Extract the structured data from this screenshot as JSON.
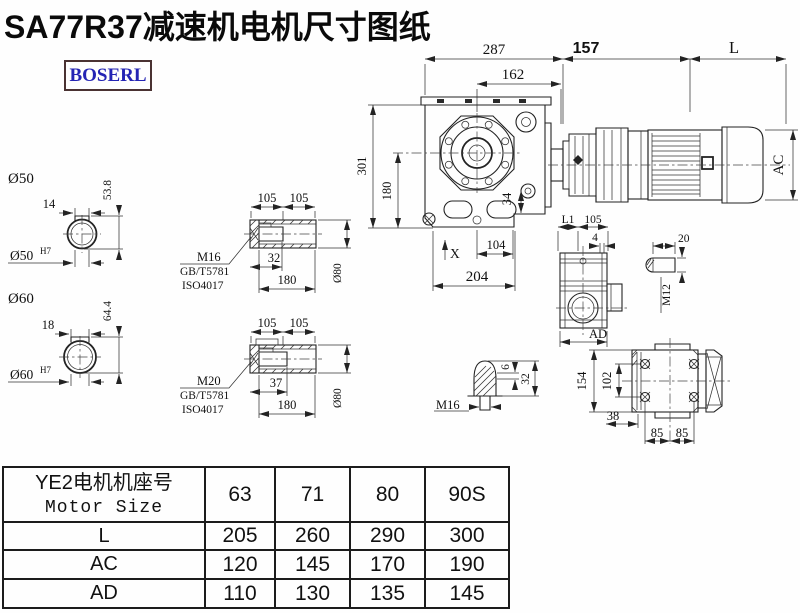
{
  "title": "SA77R37减速机电机尺寸图纸",
  "logo": "BOSERL",
  "main_view": {
    "d287": "287",
    "d162": "162",
    "d157": "157",
    "dL": "L",
    "dAC": "AC",
    "d301": "301",
    "d180": "180",
    "d34": "34",
    "dX": "X",
    "d104": "104",
    "d204": "204"
  },
  "shaft50": {
    "dia": "Ø50",
    "key_w": "14",
    "height": "53.8",
    "bore": "Ø50",
    "bore_tol": "H7"
  },
  "shaft60": {
    "dia": "Ø60",
    "key_w": "18",
    "height": "64.4",
    "bore": "Ø60",
    "bore_tol": "H7"
  },
  "bush1": {
    "len1": "105",
    "len2": "105",
    "depth": "32",
    "total": "180",
    "dia": "Ø80",
    "bolt": "M16",
    "std1": "GB/T5781",
    "std2": "ISO4017"
  },
  "bush2": {
    "len1": "105",
    "len2": "105",
    "depth": "37",
    "total": "180",
    "dia": "Ø80",
    "bolt": "M20",
    "std1": "GB/T5781",
    "std2": "ISO4017"
  },
  "side_view": {
    "dL1": "L1",
    "d105": "105",
    "d4": "4",
    "dAD": "AD"
  },
  "key_view": {
    "d20": "20",
    "thread": "M12"
  },
  "plug_view": {
    "d6": "6",
    "d32": "32",
    "thread": "M16"
  },
  "rear_view": {
    "d154": "154",
    "d102": "102",
    "d38": "38",
    "d85a": "85",
    "d85b": "85"
  },
  "table": {
    "header_cn": "YE2电机机座号",
    "header_en": "Motor Size",
    "columns": [
      "63",
      "71",
      "80",
      "90S"
    ],
    "rows": [
      {
        "label": "L",
        "values": [
          "205",
          "260",
          "290",
          "300"
        ]
      },
      {
        "label": "AC",
        "values": [
          "120",
          "145",
          "170",
          "190"
        ]
      },
      {
        "label": "AD",
        "values": [
          "110",
          "130",
          "135",
          "145"
        ]
      }
    ]
  }
}
